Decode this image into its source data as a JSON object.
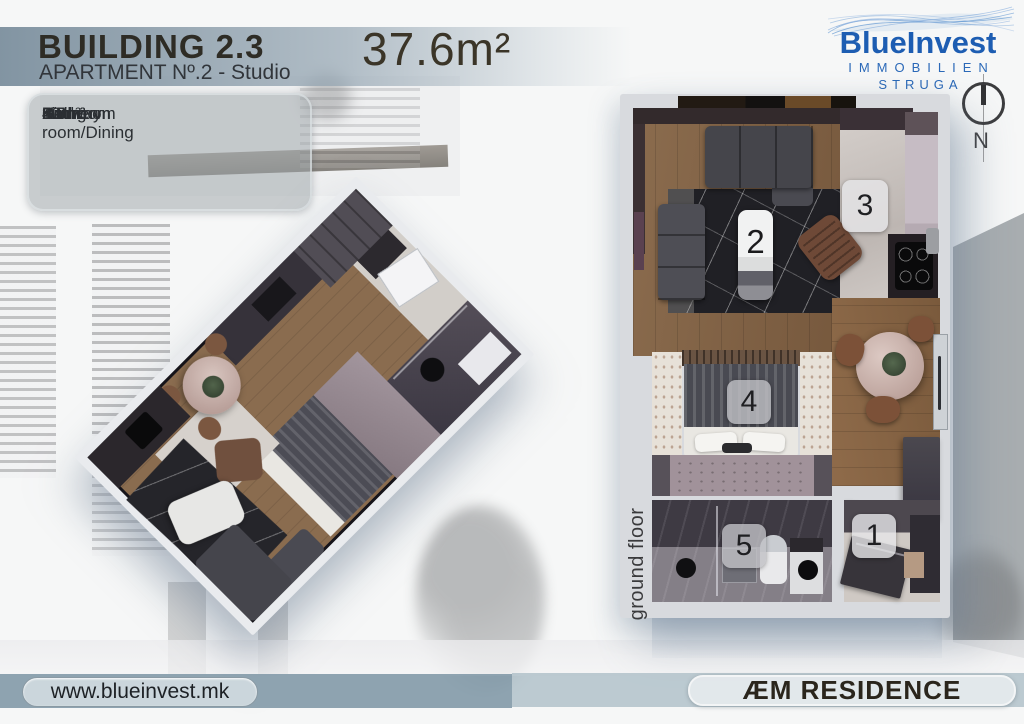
{
  "header": {
    "building_title": "BUILDING 2.3",
    "apartment_subtitle": "APARTMENT Nº.2 - Studio",
    "total_area": "37.6m²"
  },
  "room_list": {
    "items": [
      {
        "num": "1.",
        "label": "Hallway",
        "area": "2.8m²"
      },
      {
        "num": "2.",
        "label": "Living room/Dining",
        "area": "20m²"
      },
      {
        "num": "3.",
        "label": "Kitchen",
        "area": "3.8m²"
      },
      {
        "num": "4.",
        "label": "Bedroom",
        "area": "6.5m²"
      },
      {
        "num": "5.",
        "label": "Bathroom",
        "area": "4.5m²"
      }
    ]
  },
  "logo": {
    "brand": "BlueInvest",
    "line2": "IMMOBILIEN",
    "line3": "STRUGA",
    "brand_color": "#1d5db2"
  },
  "compass": {
    "north_label": "N"
  },
  "floor_plan": {
    "caption": "ground floor",
    "room_numbers": {
      "hallway": "1",
      "living": "2",
      "kitchen": "3",
      "bedroom": "4",
      "bathroom": "5"
    }
  },
  "footer": {
    "website": "www.blueinvest.mk",
    "residence": "ÆM RESIDENCE"
  },
  "colors": {
    "header_band": "#8ba0ad",
    "footer_left_band": "#8097a6",
    "footer_right_band": "#afbfc8",
    "wood_floor": "#8a6b4d",
    "dark_rug": "#202025",
    "accent_blue": "#1d5db2"
  }
}
